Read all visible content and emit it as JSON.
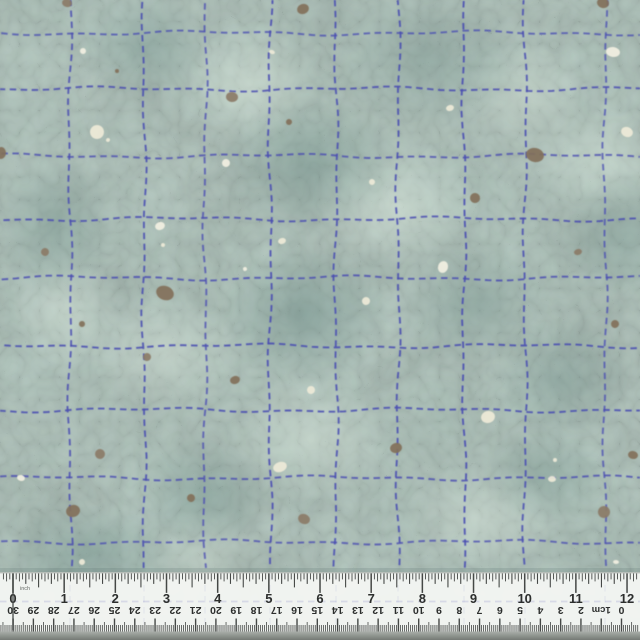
{
  "image": {
    "description": "Teal mottled quilting fabric swatch with hand-stitched navy dashed grid, taupe and cream paint specks, photographed with a 12-inch / 30-cm ruler along the bottom edge",
    "width": 640,
    "height": 640
  },
  "fabric": {
    "base_color": "#b2cbc1",
    "mottle_dark_color": "#7fa49b",
    "mottle_light_color": "#d8e6d9",
    "crackle_color": "#6d8f8c",
    "stitch_color": "#4a4eb2",
    "stitch_dash_px": [
      6.5,
      4.5
    ],
    "stitch_width_px": 1.9,
    "grid_vertical_x": [
      70,
      144,
      205,
      270,
      336,
      398,
      464,
      525,
      605
    ],
    "grid_horizontal_y": [
      33,
      89,
      156,
      219,
      278,
      346,
      410,
      478,
      542
    ],
    "spots": {
      "brown_color": "#82705a",
      "brown_alt_color": "#8b7b67",
      "cream_color": "#ece9d7",
      "cream_alt_color": "#f0eee0",
      "brown": [
        [
          67,
          3,
          5,
          4
        ],
        [
          303,
          9,
          6,
          5
        ],
        [
          603,
          3,
          6,
          5
        ],
        [
          232,
          97,
          6,
          5
        ],
        [
          289,
          122,
          3,
          3
        ],
        [
          1,
          153,
          5,
          6
        ],
        [
          45,
          252,
          4,
          4
        ],
        [
          165,
          293,
          9,
          7
        ],
        [
          82,
          324,
          3,
          3
        ],
        [
          147,
          357,
          4,
          4
        ],
        [
          535,
          155,
          9,
          7
        ],
        [
          475,
          198,
          5,
          5
        ],
        [
          578,
          252,
          4,
          3
        ],
        [
          615,
          324,
          4,
          4
        ],
        [
          235,
          380,
          5,
          4
        ],
        [
          100,
          454,
          5,
          5
        ],
        [
          73,
          511,
          7,
          6
        ],
        [
          191,
          498,
          4,
          4
        ],
        [
          304,
          519,
          6,
          5
        ],
        [
          396,
          448,
          6,
          5
        ],
        [
          633,
          455,
          5,
          4
        ],
        [
          604,
          512,
          6,
          6
        ],
        [
          117,
          71,
          2,
          2
        ]
      ],
      "cream": [
        [
          83,
          51,
          3,
          3
        ],
        [
          97,
          132,
          7,
          7
        ],
        [
          108,
          140,
          2,
          2
        ],
        [
          226,
          163,
          4,
          4
        ],
        [
          272,
          52,
          3,
          2
        ],
        [
          372,
          182,
          3,
          3
        ],
        [
          613,
          52,
          7,
          5
        ],
        [
          450,
          108,
          4,
          3
        ],
        [
          627,
          132,
          6,
          5
        ],
        [
          160,
          226,
          5,
          4
        ],
        [
          163,
          245,
          2,
          2
        ],
        [
          282,
          241,
          4,
          3
        ],
        [
          245,
          269,
          2,
          2
        ],
        [
          366,
          301,
          4,
          4
        ],
        [
          311,
          390,
          4,
          4
        ],
        [
          21,
          478,
          4,
          3
        ],
        [
          280,
          467,
          7,
          5
        ],
        [
          82,
          562,
          3,
          3
        ],
        [
          443,
          267,
          5,
          6
        ],
        [
          488,
          417,
          7,
          6
        ],
        [
          552,
          479,
          4,
          3
        ],
        [
          616,
          562,
          3,
          2
        ],
        [
          555,
          460,
          2,
          2
        ]
      ]
    }
  },
  "ruler": {
    "top_y": 572,
    "background_color": "#f3f5f2",
    "edge_shadow_color": "#a9afaa",
    "tick_color": "#454846",
    "number_color": "#2c2e2d",
    "unit_text_color": "#686c69",
    "bottom_strip_top_color": "#a9aea9",
    "bottom_strip_bottom_color": "#757a75",
    "inch": {
      "unit_label": "inch",
      "labels": [
        "0",
        "1",
        "2",
        "3",
        "4",
        "5",
        "6",
        "7",
        "8",
        "9",
        "10",
        "11",
        "12"
      ],
      "origin_x": 13,
      "spacing_px": 51.17,
      "divisions_per_inch": 16
    },
    "cm": {
      "labels_left_to_right": [
        "30",
        "29",
        "28",
        "27",
        "26",
        "25",
        "24",
        "23",
        "22",
        "21",
        "20",
        "19",
        "18",
        "17",
        "16",
        "15",
        "14",
        "13",
        "12",
        "11",
        "10",
        "9",
        "8",
        "7",
        "6",
        "5",
        "4",
        "3",
        "2",
        "1cm",
        "0"
      ],
      "zero_x": 621.5,
      "spacing_px": 20.28,
      "upside_down": true
    }
  }
}
